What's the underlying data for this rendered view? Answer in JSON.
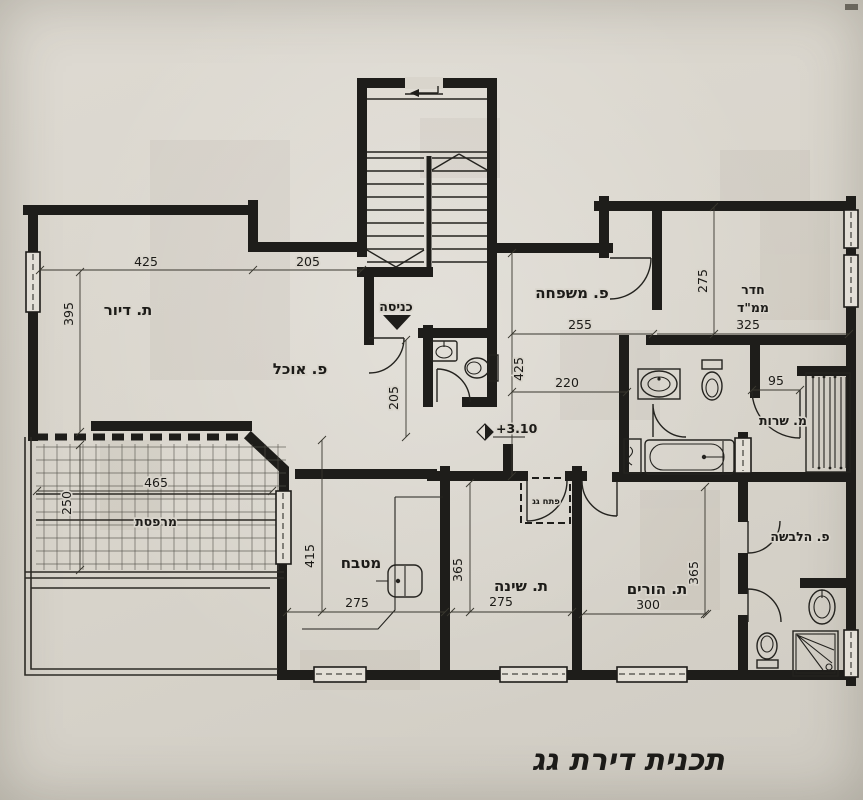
{
  "drawing": {
    "title": "תכנית דירת גג",
    "level_marker": "+3.10",
    "entrance_label": "כניסה",
    "roof_hatch_label": "פתח גג"
  },
  "rooms": {
    "living": "ת. דיור",
    "dining": "פ. אוכל",
    "family": "פ. משפחה",
    "mamad_line1": "חדר",
    "mamad_line2": "ממ\"ד",
    "service": "מ. שרות",
    "balcony": "מרפסת",
    "kitchen": "מטבח",
    "bedroom": "ת. שינה",
    "parents": "ת. הורים",
    "dressing": "פ. הלבשה"
  },
  "dimensions": {
    "living_width": "425",
    "entry_width": "205",
    "living_height": "395",
    "entry_depth": "205",
    "family_width": "255",
    "mamad_width": "325",
    "mamad_height": "275",
    "hall_height": "425",
    "hall_width": "220",
    "service_opening": "95",
    "balcony_width": "465",
    "balcony_depth": "250",
    "kitchen_height": "415",
    "kitchen_width": "275",
    "bedroom_width": "275",
    "bedroom_height": "365",
    "parents_width": "300",
    "parents_height": "365"
  },
  "colors": {
    "paper": "#d9d5cc",
    "ink": "#1e1d1a"
  }
}
